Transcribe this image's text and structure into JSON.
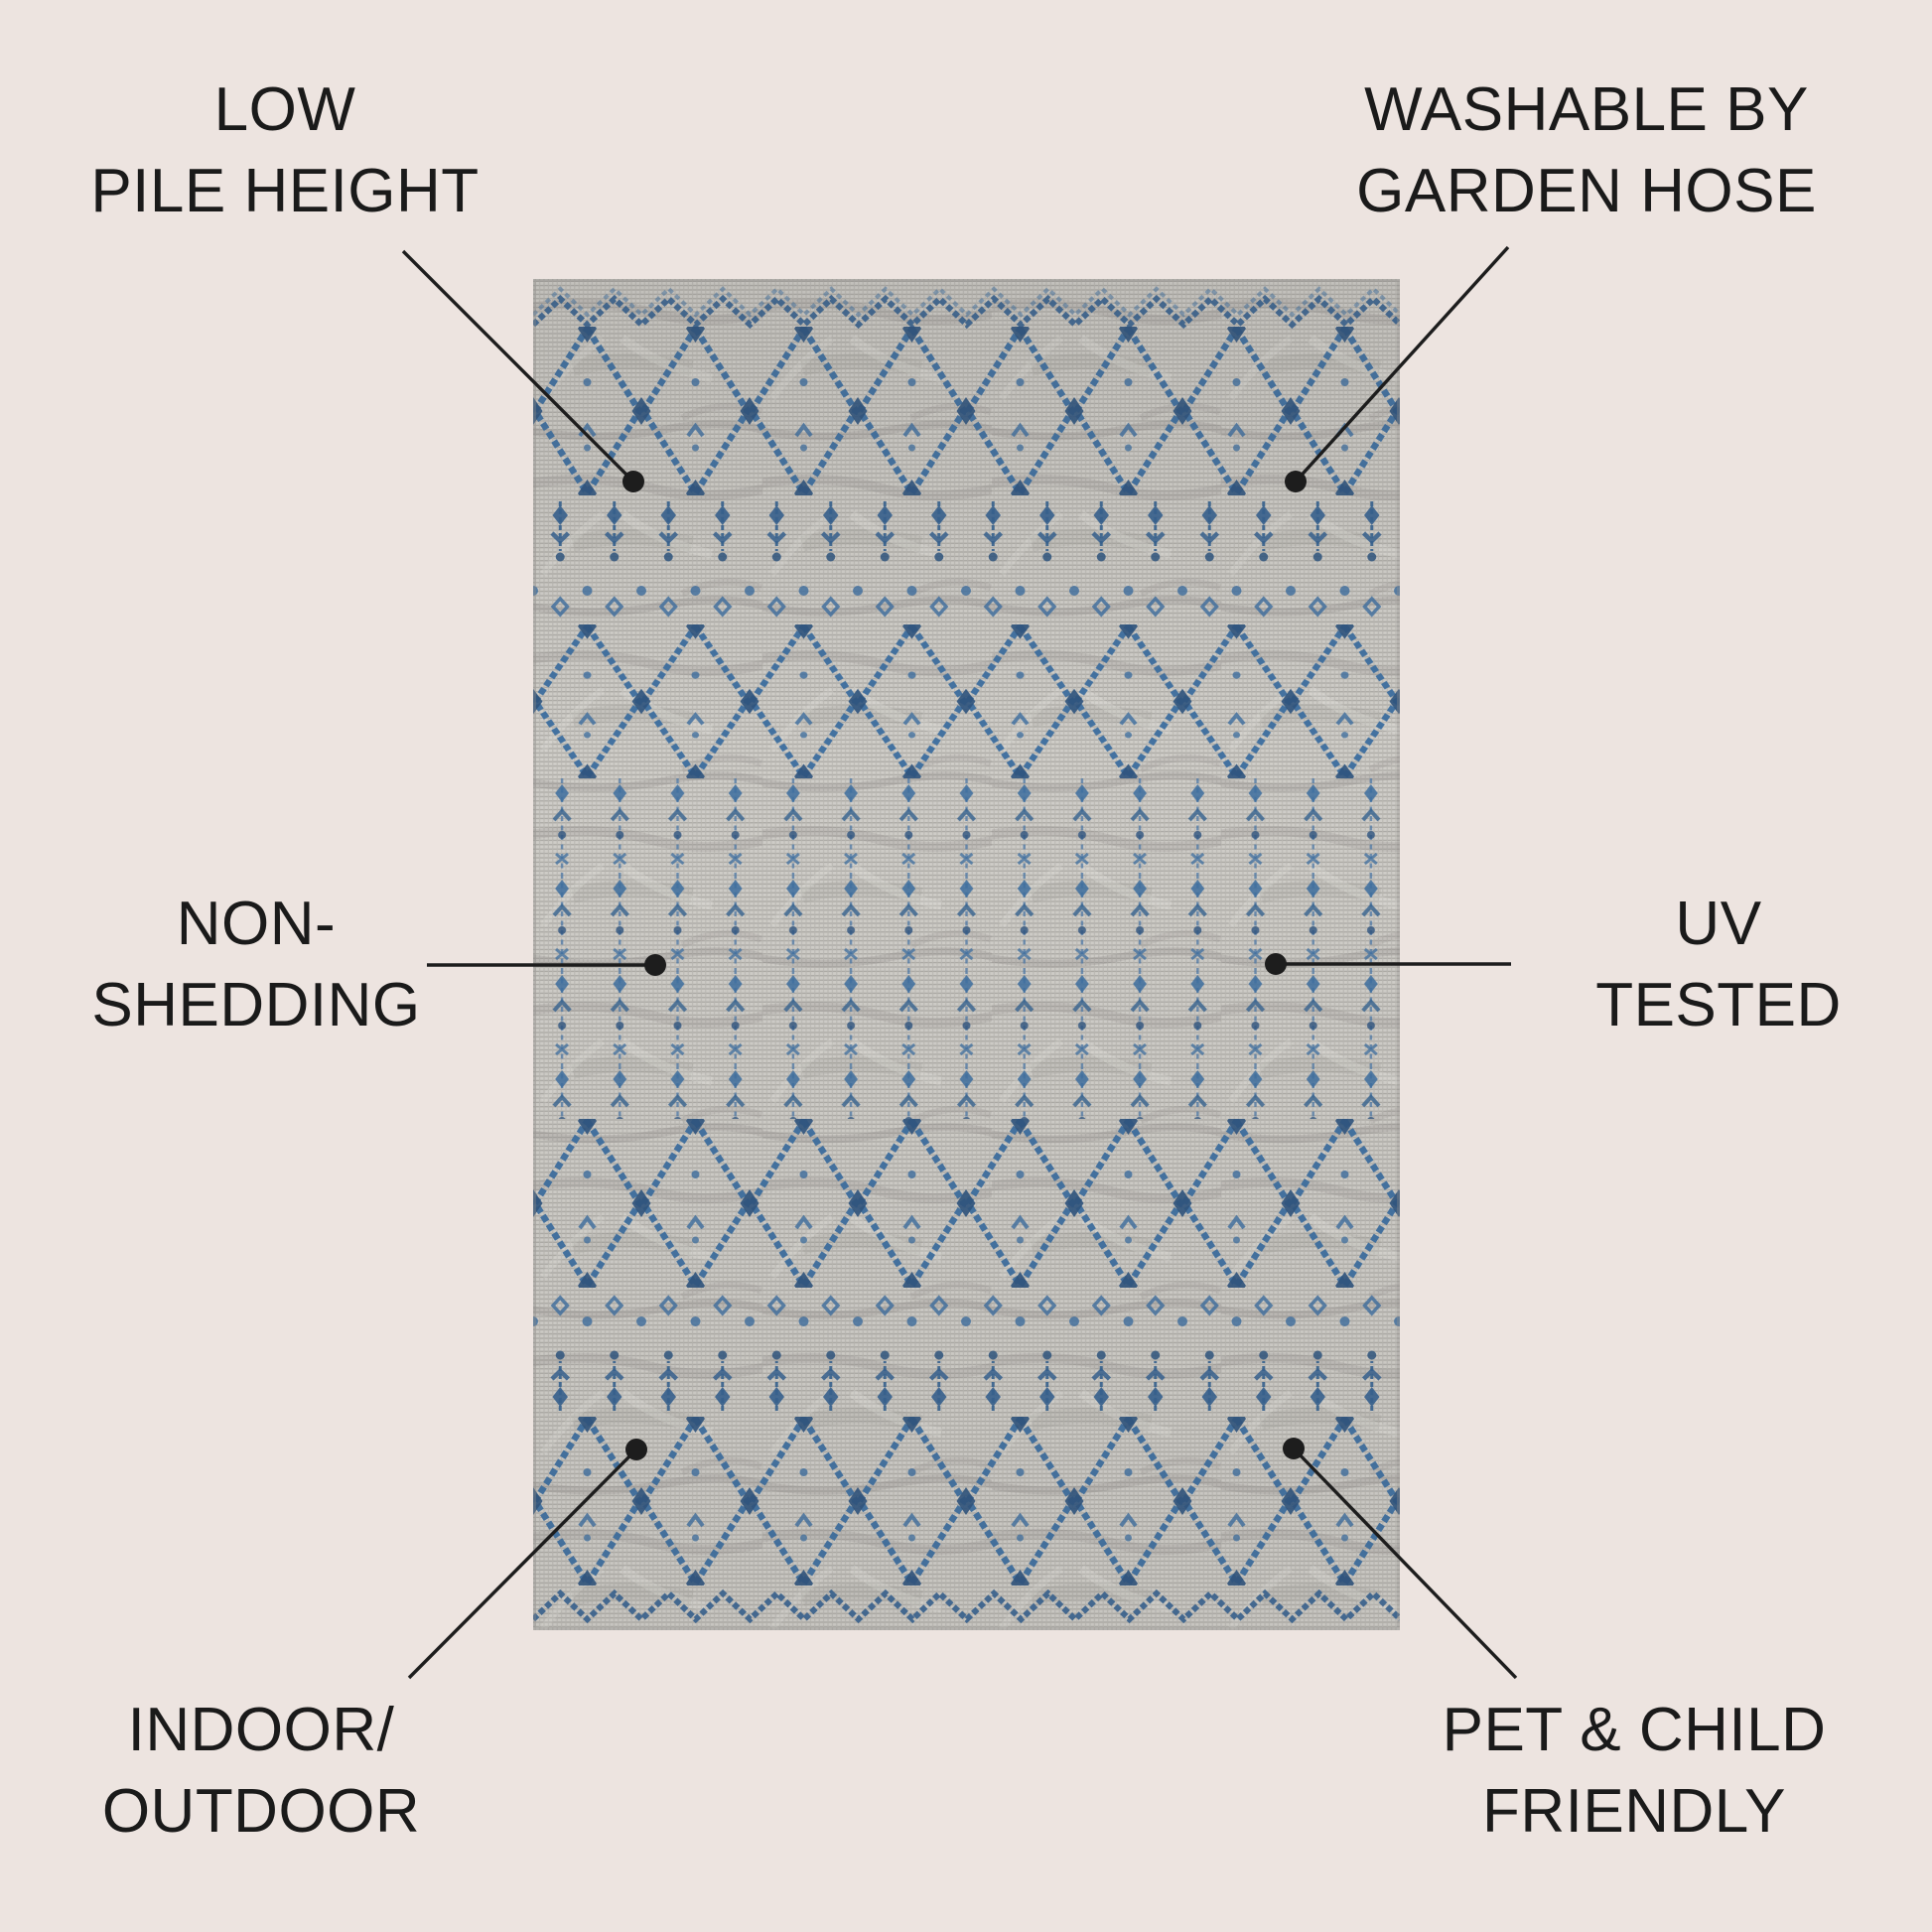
{
  "page": {
    "background_color": "#ede4e0",
    "text_color": "#1a1a1a",
    "callout_line_color": "#1d1d1d"
  },
  "rug": {
    "base_color": "#c9c7c2",
    "weave_dark_color": "#8e8c88",
    "pattern_blue": "#3c6d9f",
    "pattern_blue_dark": "#2d537e"
  },
  "callouts": [
    {
      "id": "low-pile-height",
      "position": "top-left",
      "lines": [
        "LOW",
        "PILE HEIGHT"
      ]
    },
    {
      "id": "washable-by-garden-hose",
      "position": "top-right",
      "lines": [
        "WASHABLE BY",
        "GARDEN HOSE"
      ]
    },
    {
      "id": "non-shedding",
      "position": "middle-left",
      "lines": [
        "NON-",
        "SHEDDING"
      ]
    },
    {
      "id": "uv-tested",
      "position": "middle-right",
      "lines": [
        "UV",
        "TESTED"
      ]
    },
    {
      "id": "indoor-outdoor",
      "position": "bottom-left",
      "lines": [
        "INDOOR/",
        "OUTDOOR"
      ]
    },
    {
      "id": "pet-child-friendly",
      "position": "bottom-right",
      "lines": [
        "PET & CHILD",
        "FRIENDLY"
      ]
    }
  ]
}
